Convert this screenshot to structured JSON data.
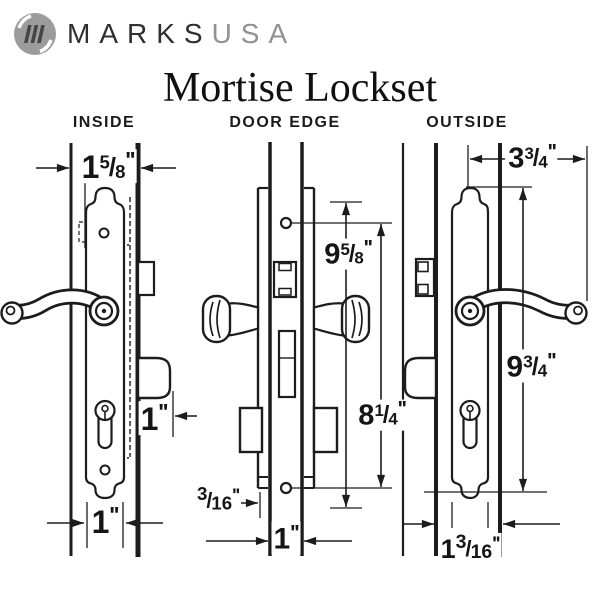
{
  "brand": {
    "name_primary": "MARKS",
    "name_secondary": "USA",
    "icon": "marks-circle-monogram-icon"
  },
  "title": "Mortise Lockset",
  "view_labels": {
    "inside": "INSIDE",
    "door_edge": "DOOR EDGE",
    "outside": "OUTSIDE"
  },
  "glyphs": {
    "fraction_slash": "/"
  },
  "dimensions": {
    "inside_door_thickness": {
      "whole": "1",
      "num": "5",
      "den": "8",
      "unit": "''"
    },
    "inside_bolt_projection": {
      "whole": "1",
      "num": "",
      "den": "",
      "unit": "''"
    },
    "inside_trim_width": {
      "whole": "1",
      "num": "",
      "den": "",
      "unit": "''"
    },
    "edge_faceplate_length": {
      "whole": "9",
      "num": "5",
      "den": "8",
      "unit": "''"
    },
    "edge_hole_spacing": {
      "whole": "8",
      "num": "1",
      "den": "4",
      "unit": "''"
    },
    "edge_faceplate_inset": {
      "whole": "",
      "num": "3",
      "den": "16",
      "unit": "''"
    },
    "edge_faceplate_width": {
      "whole": "1",
      "num": "",
      "den": "",
      "unit": "''"
    },
    "outside_handle_reach": {
      "whole": "3",
      "num": "3",
      "den": "4",
      "unit": "''"
    },
    "outside_trim_length": {
      "whole": "9",
      "num": "3",
      "den": "4",
      "unit": "''"
    },
    "outside_door_thickness": {
      "whole": "1",
      "num": "3",
      "den": "16",
      "unit": "''"
    }
  },
  "colors": {
    "line": "#1c1c1c",
    "background": "#ffffff",
    "logo_disc": "#9c9c9c",
    "logo_monogram": "#454545",
    "brand_primary_text": "#2f2f2f",
    "brand_secondary_text": "#919191"
  }
}
